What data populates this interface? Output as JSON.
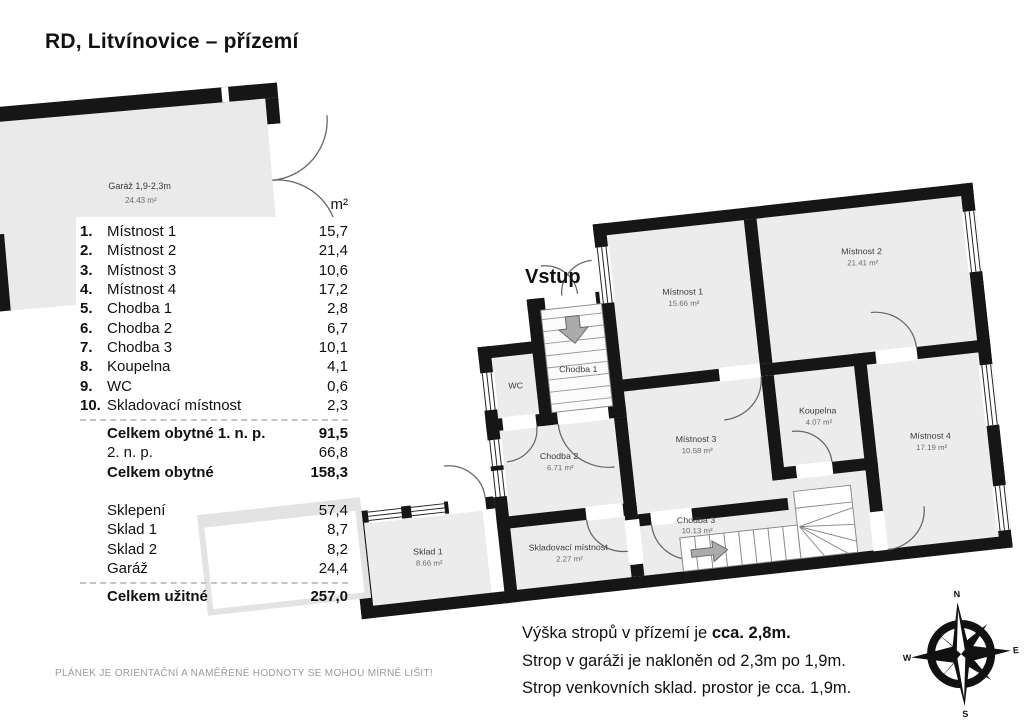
{
  "title": "RD, Litvínovice – přízemí",
  "entrance_label": "Vstup",
  "garage": {
    "name": "Garáž 1,9-2,3m",
    "area": "24.43 m²"
  },
  "legend": {
    "unit_header": "m²",
    "rows": [
      {
        "n": "1.",
        "l": "Místnost 1",
        "v": "15,7"
      },
      {
        "n": "2.",
        "l": "Místnost 2",
        "v": "21,4"
      },
      {
        "n": "3.",
        "l": "Místnost 3",
        "v": "10,6"
      },
      {
        "n": "4.",
        "l": "Místnost 4",
        "v": "17,2"
      },
      {
        "n": "5.",
        "l": "Chodba 1",
        "v": "2,8"
      },
      {
        "n": "6.",
        "l": "Chodba 2",
        "v": "6,7"
      },
      {
        "n": "7.",
        "l": "Chodba 3",
        "v": "10,1"
      },
      {
        "n": "8.",
        "l": "Koupelna",
        "v": "4,1"
      },
      {
        "n": "9.",
        "l": "WC",
        "v": "0,6"
      },
      {
        "n": "10.",
        "l": "Skladovací místnost",
        "v": "2,3"
      }
    ],
    "subtotal_rows": [
      {
        "l": "Celkem obytné 1. n. p.",
        "v": "91,5"
      },
      {
        "l": "2. n. p.",
        "v": "66,8"
      },
      {
        "l": "Celkem obytné",
        "v": "158,3"
      }
    ],
    "extra_rows": [
      {
        "l": "Sklepení",
        "v": "57,4"
      },
      {
        "l": "Sklad 1",
        "v": "8,7"
      },
      {
        "l": "Sklad 2",
        "v": "8,2"
      },
      {
        "l": "Garáž",
        "v": "24,4"
      }
    ],
    "total_row": {
      "l": "Celkem užitné",
      "v": "257,0"
    }
  },
  "plan": {
    "rooms": {
      "mistnost1": {
        "name": "Místnost 1",
        "area": "15.66 m²"
      },
      "mistnost2": {
        "name": "Místnost 2",
        "area": "21.41 m²"
      },
      "mistnost3": {
        "name": "Místnost 3",
        "area": "10.58 m²"
      },
      "mistnost4": {
        "name": "Místnost 4",
        "area": "17.19 m²"
      },
      "koupelna": {
        "name": "Koupelna",
        "area": "4.07 m²"
      },
      "chodba1": {
        "name": "Chodba 1"
      },
      "chodba2": {
        "name": "Chodba 2",
        "area": "6.71 m²"
      },
      "chodba3": {
        "name": "Chodba 3",
        "area": "10.13 m²"
      },
      "wc": {
        "name": "WC"
      },
      "skladovaci": {
        "name": "Skladovací místnost",
        "area": "2.27 m²"
      },
      "sklad1": {
        "name": "Sklad 1",
        "area": "8.66 m²"
      }
    }
  },
  "notes": {
    "line1_normal": "Výška stropů v přízemí je ",
    "line1_bold": "cca. 2,8m.",
    "line2": "Strop v garáži je nakloněn od 2,3m po 1,9m.",
    "line3": "Strop venkovních sklad. prostor je cca. 1,9m."
  },
  "disclaimer": "PLÁNEK JE ORIENTAČNÍ A NAMĚŘENÉ HODNOTY SE MOHOU MÍRNĚ LIŠIT!",
  "compass": {
    "n": "N",
    "s": "S",
    "e": "E",
    "w": "W"
  },
  "colors": {
    "wall": "#161616",
    "room_fill": "#ececec",
    "arrow": "#ababab"
  }
}
